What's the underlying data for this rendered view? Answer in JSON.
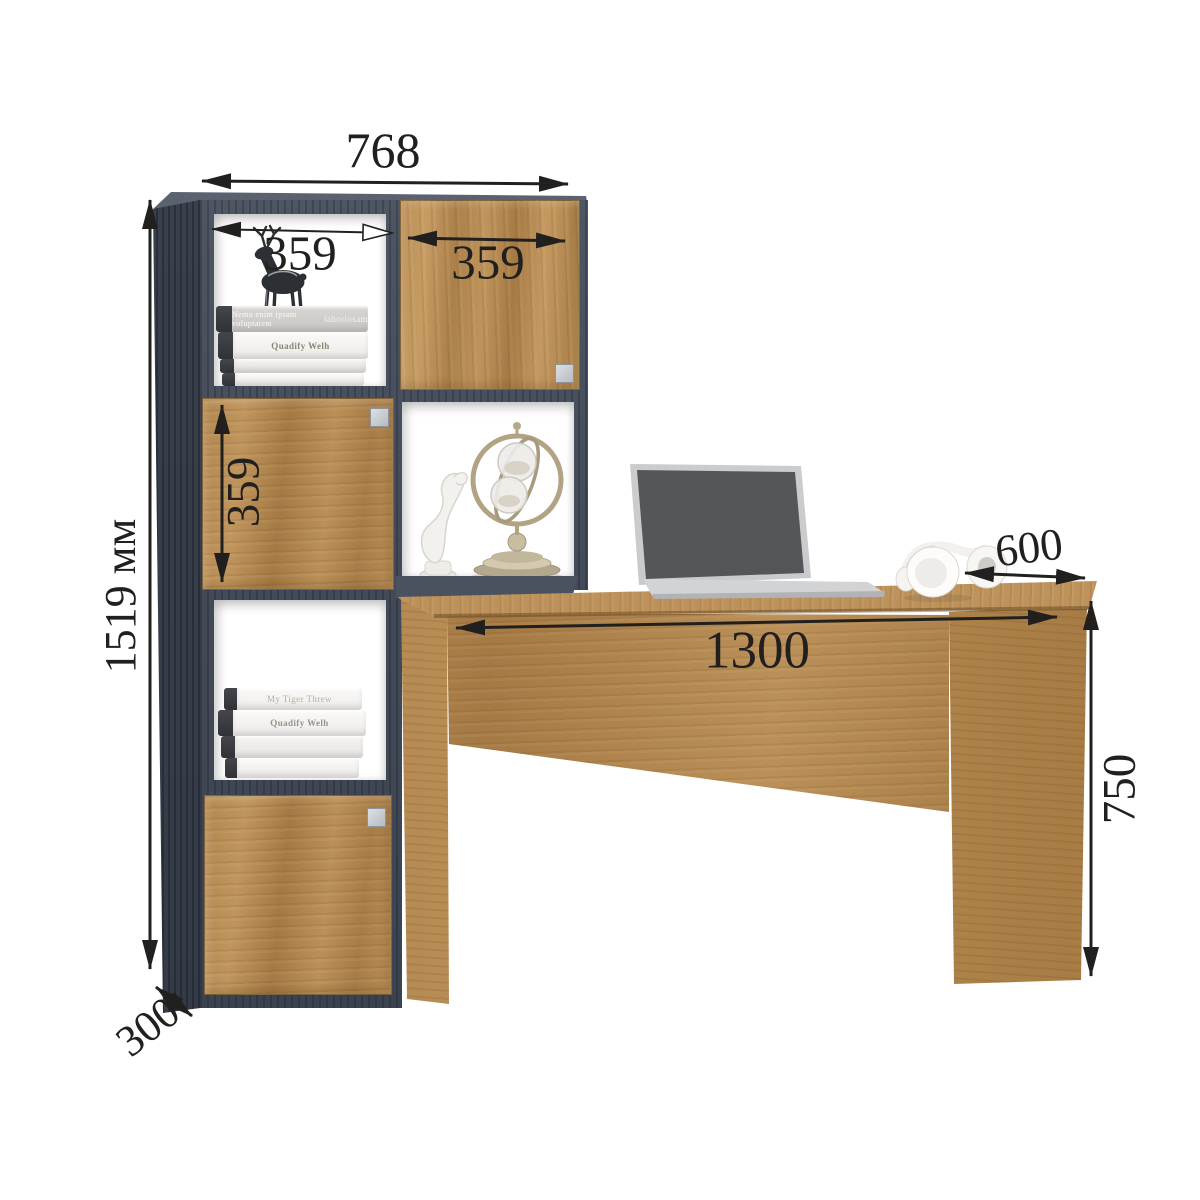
{
  "scene": {
    "type": "furniture-dimension-diagram",
    "background": "#ffffff",
    "colors": {
      "wood": "#b5894f",
      "frame_dark": "#454c59",
      "annotation": "#21201e",
      "book_spine": "#f4f3f1",
      "laptop_screen": "#55575a",
      "metal": "#b3a385"
    }
  },
  "dimensions": {
    "shelf_width": "768",
    "shelf_cell_width": "359",
    "shelf_door_width": "359",
    "shelf_door_height": "359",
    "shelf_height": "1519 мм",
    "shelf_depth": "300",
    "desk_length": "1300",
    "desk_depth": "600",
    "desk_height": "750"
  },
  "decor": {
    "books_top": {
      "line1_left": "Nemo enim ipsam voluptatem",
      "line1_right": "laboriosam",
      "line2": "Quadify Welh"
    },
    "books_bottom": {
      "line1": "My Tiger Threw",
      "line2": "Quadify Welh"
    }
  }
}
